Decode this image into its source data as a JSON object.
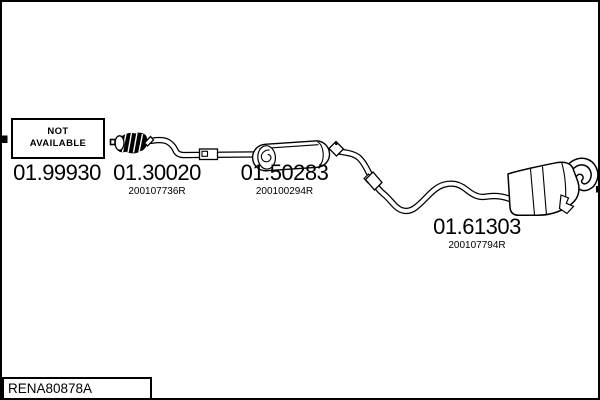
{
  "colors": {
    "background": "#ffffff",
    "line": "#000000",
    "text": "#000000"
  },
  "diagram": {
    "not_available": {
      "line1": "NOT",
      "line2": "AVAILABLE"
    },
    "parts": [
      {
        "code": "01.99930"
      },
      {
        "code": "01.30020",
        "oem": "200107736R"
      },
      {
        "code": "01.50283",
        "oem": "200100294R"
      },
      {
        "code": "01.61303",
        "oem": "200107794R"
      }
    ],
    "drawing_code": "RENA80878A"
  }
}
